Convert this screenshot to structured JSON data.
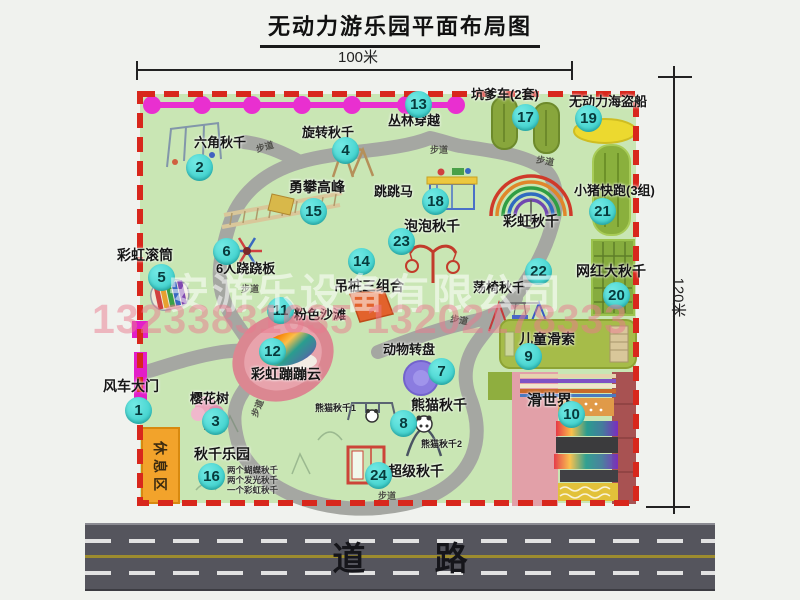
{
  "title": "无动力游乐园平面布局图",
  "dimensions": {
    "width_label": "100米",
    "height_label": "120米"
  },
  "watermark": {
    "company": "安游乐设备有限公司",
    "phone": "13233831635 13202178333"
  },
  "road": {
    "label": "道 路"
  },
  "rest_area": {
    "label": "休息区"
  },
  "colors": {
    "border_red": "#d8271c",
    "park_green": "#c9e6b4",
    "badge_cyan": "#30cac6",
    "road_gray": "#55555d",
    "chain_magenta": "#e92fd0",
    "rest_orange": "#f2a32b"
  },
  "map": {
    "attractions": [
      {
        "num": 1,
        "label": "风车大门",
        "badge": [
          138,
          410
        ],
        "text": [
          103,
          379
        ],
        "fs": 14
      },
      {
        "num": 2,
        "label": "六角秋千",
        "badge": [
          199,
          167
        ],
        "text": [
          194,
          136
        ]
      },
      {
        "num": 3,
        "label": "樱花树",
        "badge": [
          215,
          421
        ],
        "text": [
          190,
          392
        ]
      },
      {
        "num": 4,
        "label": "旋转秋千",
        "badge": [
          345,
          150
        ],
        "text": [
          302,
          126
        ]
      },
      {
        "num": 5,
        "label": "彩虹滚筒",
        "badge": [
          161,
          277
        ],
        "text": [
          117,
          248
        ],
        "fs": 14
      },
      {
        "num": 6,
        "label": "6人跷跷板",
        "badge": [
          226,
          251
        ],
        "text": [
          216,
          262
        ]
      },
      {
        "num": 7,
        "label": "动物转盘",
        "badge": [
          441,
          371
        ],
        "text": [
          383,
          343
        ]
      },
      {
        "num": 8,
        "label": "熊猫秋千",
        "badge": [
          403,
          423
        ],
        "text": [
          411,
          398
        ],
        "fs": 14
      },
      {
        "num": 9,
        "label": "儿童滑索",
        "badge": [
          528,
          356
        ],
        "text": [
          519,
          332
        ],
        "fs": 14
      },
      {
        "num": 10,
        "label": "滑世界",
        "badge": [
          571,
          414
        ],
        "text": [
          527,
          393
        ],
        "fs": 15
      },
      {
        "num": 11,
        "label": "粉色沙滩",
        "badge": [
          280,
          310
        ],
        "text": [
          294,
          308
        ]
      },
      {
        "num": 12,
        "label": "彩虹蹦蹦云",
        "badge": [
          272,
          351
        ],
        "text": [
          251,
          367
        ],
        "fs": 14
      },
      {
        "num": 13,
        "label": "丛林穿越",
        "badge": [
          418,
          104
        ],
        "text": [
          388,
          114
        ]
      },
      {
        "num": 14,
        "label": "吊桩三组合",
        "badge": [
          361,
          261
        ],
        "text": [
          334,
          279
        ],
        "fs": 14
      },
      {
        "num": 15,
        "label": "勇攀高峰",
        "badge": [
          313,
          211
        ],
        "text": [
          289,
          180
        ],
        "fs": 14
      },
      {
        "num": 16,
        "label": "秋千乐园",
        "badge": [
          211,
          476
        ],
        "text": [
          194,
          447
        ],
        "fs": 14
      },
      {
        "num": 17,
        "label": "坑爹车(2套)",
        "badge": [
          525,
          117
        ],
        "text": [
          471,
          88
        ]
      },
      {
        "num": 18,
        "label": "跳跳马",
        "badge": [
          435,
          201
        ],
        "text": [
          374,
          185
        ]
      },
      {
        "num": 19,
        "label": "无动力海盗船",
        "badge": [
          588,
          118
        ],
        "text": [
          569,
          95
        ]
      },
      {
        "num": 20,
        "label": "网红大秋千",
        "badge": [
          616,
          295
        ],
        "text": [
          576,
          264
        ],
        "fs": 14
      },
      {
        "num": 21,
        "label": "小猪快跑(3组)",
        "badge": [
          602,
          211
        ],
        "text": [
          574,
          184
        ]
      },
      {
        "num": 22,
        "label": "荡椅秋千",
        "badge": [
          538,
          271
        ],
        "text": [
          473,
          281
        ]
      },
      {
        "num": 23,
        "label": "泡泡秋千",
        "badge": [
          401,
          241
        ],
        "text": [
          404,
          219
        ],
        "fs": 14
      },
      {
        "num": 24,
        "label": "超级秋千",
        "badge": [
          378,
          475
        ],
        "text": [
          388,
          464
        ],
        "fs": 14
      }
    ],
    "extra_labels": [
      {
        "label": "彩虹秋千",
        "text": [
          503,
          214
        ],
        "fs": 14
      }
    ],
    "small_labels": [
      {
        "text": "熊猫秋千1",
        "pos": [
          315,
          404
        ]
      },
      {
        "text": "熊猫秋千2",
        "pos": [
          421,
          440
        ]
      }
    ],
    "swing_park_notes": {
      "pos": [
        227,
        465
      ],
      "lines": [
        "两个蝴蝶秋千",
        "两个发光秋千",
        "一个彩虹秋千"
      ]
    },
    "path_labels": [
      {
        "text": "步道",
        "pos": [
          256,
          143
        ],
        "rot": -15
      },
      {
        "text": "步道",
        "pos": [
          430,
          146
        ],
        "rot": 0
      },
      {
        "text": "步道",
        "pos": [
          536,
          157
        ],
        "rot": 10
      },
      {
        "text": "步道",
        "pos": [
          241,
          285
        ],
        "rot": 0
      },
      {
        "text": "步道",
        "pos": [
          450,
          316
        ],
        "rot": 10
      },
      {
        "text": "步道",
        "pos": [
          378,
          492
        ],
        "rot": 0
      },
      {
        "text": "步道",
        "pos": [
          249,
          404
        ],
        "rot": -68
      }
    ]
  }
}
